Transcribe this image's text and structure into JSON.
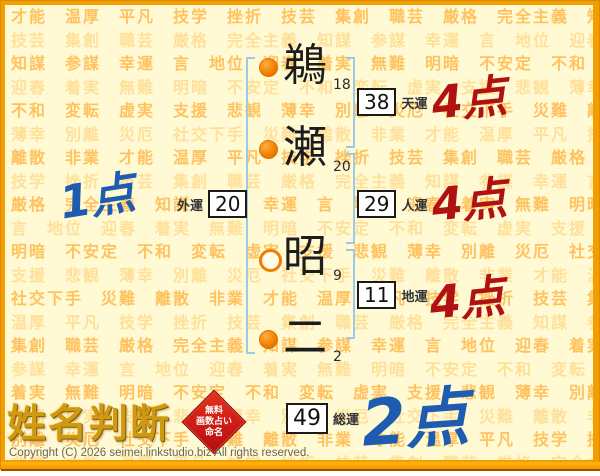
{
  "page": {
    "logo_text": "姓名判断",
    "stamp_lines": [
      "無料",
      "画数占い",
      "命名"
    ],
    "copyright": "Copyright (C) 2026 seimei.linkstudio.biz All rights reserved."
  },
  "name_chart": {
    "chars": [
      {
        "glyph": "鵜",
        "strokes": "18",
        "marker": "filled"
      },
      {
        "glyph": "瀬",
        "strokes": "20",
        "marker": "filled"
      },
      {
        "glyph": "昭",
        "strokes": "9",
        "marker": "hollow"
      },
      {
        "glyph": "二",
        "strokes": "2",
        "marker": "filled"
      }
    ],
    "fortunes": [
      {
        "id": "tenun",
        "label": "天運",
        "value": "38",
        "score": "4点",
        "score_color": "#b01111"
      },
      {
        "id": "jinun",
        "label": "人運",
        "value": "29",
        "score": "4点",
        "score_color": "#b01111"
      },
      {
        "id": "chiun",
        "label": "地運",
        "value": "11",
        "score": "4点",
        "score_color": "#b01111"
      },
      {
        "id": "gaiun",
        "label": "外運",
        "value": "20",
        "score": "1点",
        "score_color": "#1d5cb0"
      },
      {
        "id": "soun",
        "label": "総運",
        "value": "49",
        "score": "2点",
        "score_color": "#1d5cb0"
      }
    ]
  },
  "background": {
    "words": [
      "才能",
      "温厚",
      "平凡",
      "技学",
      "挫折",
      "技芸",
      "集創",
      "職芸",
      "厳格",
      "完全主義",
      "知謀",
      "参謀",
      "幸運",
      "言",
      "地位",
      "迎春",
      "着実",
      "無難",
      "明暗",
      "不安定",
      "不和",
      "変転",
      "虚実",
      "支援",
      "悲観",
      "薄幸",
      "別離",
      "災厄",
      "社交下手",
      "災難",
      "離散",
      "非業"
    ]
  },
  "colors": {
    "frame_orange": "#f29d00",
    "page_bg": "#fffad4",
    "bg_word_dark": "#ffc261",
    "bg_word_light": "#ffe09a",
    "bracket_blue": "#9ccbe9",
    "marker_orange": "#f07d00",
    "score_red": "#b01111",
    "score_blue": "#1d5cb0",
    "stamp_red": "#b50b12",
    "logo_gold": "#cf9a12"
  }
}
